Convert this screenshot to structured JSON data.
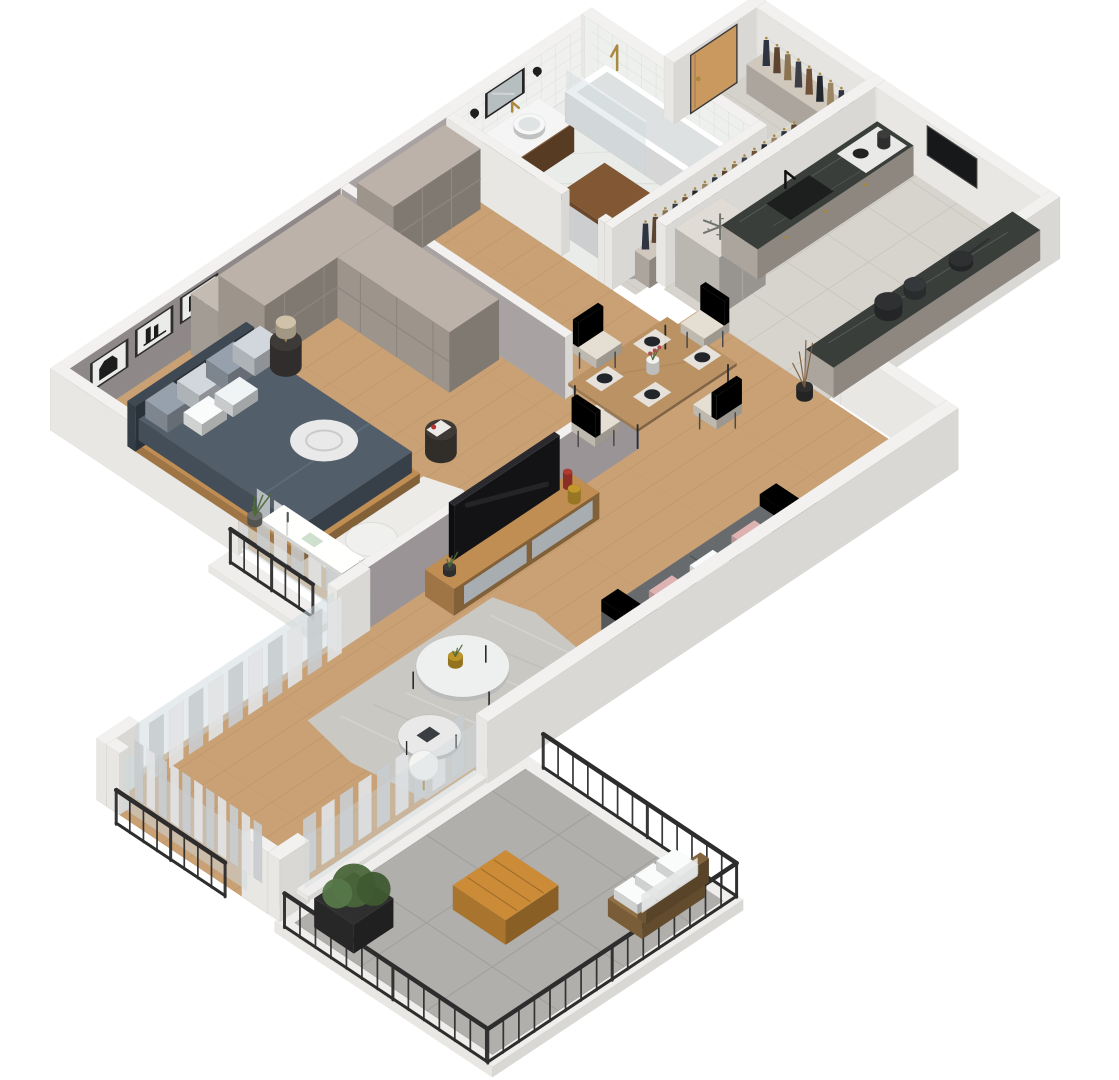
{
  "scene": {
    "type": "isometric-3d-floor-plan-render",
    "view": "cutaway dollhouse isometric view of a one-bedroom apartment",
    "background": "#ffffff",
    "rooms": [
      {
        "id": "bedroom",
        "label": "Bedroom",
        "floor": "wood",
        "furniture": [
          "double-bed",
          "gray-pillows",
          "white-pillows",
          "swirl-blanket",
          "headboard",
          "wall-art-frames",
          "paneled-wardrobe",
          "open-shelf-with-boxes",
          "round-nightstand",
          "table-lamp",
          "dark-side-table-with-books",
          "white-fluffy-rug",
          "fluffy-pouf",
          "desk",
          "window-with-railing",
          "grass-plant"
        ]
      },
      {
        "id": "hallway",
        "label": "Hallway",
        "floor": "wood",
        "furniture": [
          "paneled-closet",
          "open-gray-doors"
        ]
      },
      {
        "id": "bathroom",
        "label": "Bathroom & laundry",
        "floor": "white marble",
        "furniture": [
          "bathtub",
          "glass-shower-screen",
          "brass-shower-fixture",
          "wood-vanity",
          "white-basin",
          "black-framed-mirror",
          "black-wall-sconces",
          "washing-machine",
          "wood-laundry-counter",
          "white-square-wall-tiles"
        ]
      },
      {
        "id": "entry",
        "label": "Entry hall",
        "floor": "beige tile",
        "furniture": [
          "wooden-front-door",
          "coat-rail-with-clothes",
          "low-cabinet"
        ]
      },
      {
        "id": "kitchen",
        "label": "Kitchen",
        "floor": "gray tile",
        "furniture": [
          "fridge-cabinet",
          "snowflake-marker",
          "black-sink",
          "black-faucet",
          "beige-base-cabinets",
          "dark-marble-counters",
          "two-burner-cooktop",
          "kettle",
          "wall-niche",
          "pots-and-pans"
        ]
      },
      {
        "id": "living-dining",
        "label": "Living & dining room",
        "floor": "wood",
        "furniture": [
          "wooden-dining-table",
          "cream-dining-chairs",
          "placemats-and-plates",
          "flower-vase",
          "flat-screen-tv",
          "wood-media-console",
          "decor-vases",
          "gray-sofa",
          "pink-and-white-throw-pillows",
          "round-coffee-tables",
          "gold-plant-pot",
          "sphere-floor-lamp",
          "mottled-area-rug",
          "sheer-curtains",
          "branch-decor"
        ]
      },
      {
        "id": "balcony",
        "label": "Balcony",
        "floor": "gray tile",
        "furniture": [
          "dark-metal-railing",
          "wooden-slat-table",
          "bench-with-white-cushions",
          "black-planter-with-shrub"
        ]
      }
    ],
    "icons": [
      {
        "name": "snowflake-icon",
        "meaning": "refrigerator / cooling appliance marker",
        "location": "top face of the fridge cabinet in the kitchen"
      }
    ],
    "palette": {
      "wall_white": "#f2f1ef",
      "wall_face_light": "#e8e7e4",
      "wall_face_dark": "#d9d8d4",
      "bedroom_wall_gray": "#8f8889",
      "interior_gray": "#a9a2a2",
      "wardrobe_greige": "#b2a89f",
      "wood_floor": "#c9a175",
      "wood_floor_line": "#b68e62",
      "kitchen_tile": "#d7d4ce",
      "kitchen_tile_line": "#c3c0b9",
      "entry_tile": "#d5d2cb",
      "bath_floor": "#eaece9",
      "balcony_tile": "#b0afac",
      "balcony_tile_line": "#9e9d99",
      "counter_dark_marble": "#3a3e3b",
      "marble_vein": "#787d76",
      "cabinet_beige": "#c4bcb2",
      "wood_furniture": "#b5854e",
      "door_wood": "#c9995f",
      "bed_duvet": "#4d5964",
      "pillow_light": "#c6cbd1",
      "pillow_mid": "#8e98a3",
      "sofa_gray": "#616568",
      "pillow_pink": "#d2a8a8",
      "chair_cream": "#d8d2c7",
      "rug_gray": "#cac9c5",
      "rug_white": "#ededeb",
      "metal_dark": "#2d2d2d",
      "brass": "#a8893f",
      "plant_green": "#4e6a3b",
      "curtain_light": "#e2e4e5",
      "curtain_dark": "#c9cdd0",
      "glass": "#cfdadf",
      "tv_black": "#17181a",
      "washer_white": "#e9eaeb",
      "fridge_gray": "#d3cfc8",
      "snowflake_color": "#6f746c"
    }
  }
}
